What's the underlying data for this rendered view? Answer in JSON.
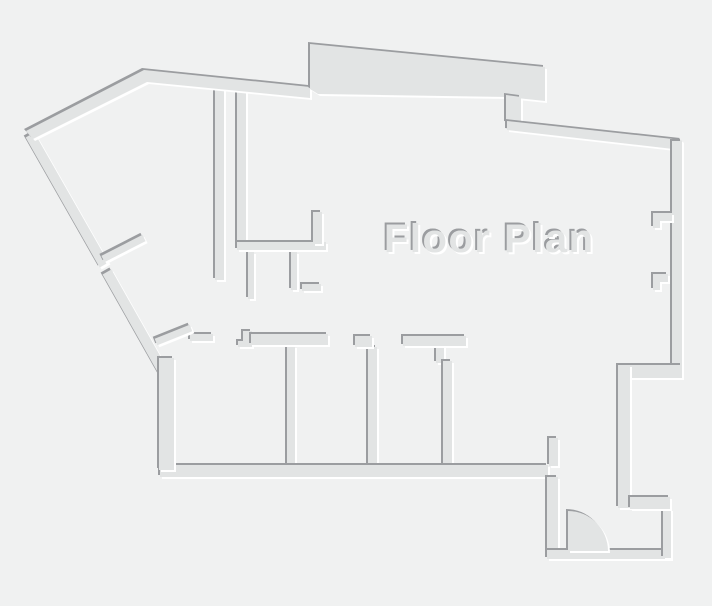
{
  "floorplan": {
    "title": "Floor Plan",
    "canvas": {
      "width": 712,
      "height": 606
    },
    "colors": {
      "background": "#f0f1f1",
      "wall_fill": "#e2e4e4",
      "edge_shadow": "#9b9da0",
      "edge_highlight": "#ffffff"
    },
    "title_pos": {
      "x": 384,
      "y": 252
    },
    "shapes": [
      {
        "name": "corridor-wall-left",
        "rect": [
          215,
          88,
          9,
          192
        ]
      },
      {
        "name": "corridor-wall-right",
        "rect": [
          237,
          90,
          9,
          159
        ]
      },
      {
        "name": "closet-stub-1",
        "rect": [
          248,
          252,
          6,
          47
        ]
      },
      {
        "name": "closet-stub-2",
        "rect": [
          291,
          252,
          6,
          38
        ]
      },
      {
        "name": "closet-stub-3",
        "rect": [
          302,
          284,
          19,
          7
        ]
      },
      {
        "name": "closet-wall-horizontal",
        "rect": [
          237,
          242,
          89,
          8
        ]
      },
      {
        "name": "closet-stub-up",
        "rect": [
          313,
          212,
          9,
          32
        ]
      },
      {
        "name": "diagonal-wall-upper",
        "points": "25.7,137.5 34.3,132.5 108.4,262.5 99.7,267.5"
      },
      {
        "name": "diagonal-wall-lower",
        "points": "102.6,274.5 111.4,269.5 168.4,370.5 159.6,375.5"
      },
      {
        "name": "room-divider-1",
        "rect": [
          287,
          346,
          8,
          121
        ]
      },
      {
        "name": "room-divider-2",
        "rect": [
          368,
          347,
          9,
          119
        ]
      },
      {
        "name": "room-divider-3-stub",
        "rect": [
          436,
          344,
          8,
          19
        ]
      },
      {
        "name": "room-divider-3",
        "rect": [
          443,
          361,
          9,
          105
        ]
      },
      {
        "name": "outer-wall-top-left",
        "points": "26,131 144,70 310,87 310,98 147,82 33,139"
      },
      {
        "name": "top-band-wall",
        "points": "310,44 545,67 545,101 507,97 318,94 310,89"
      },
      {
        "name": "top-band-step",
        "points": "506,95 521,97 521,124 506,123"
      },
      {
        "name": "outer-wall-top-right",
        "points": "507,121 682,140 673,149 507,130"
      },
      {
        "name": "outer-wall-right",
        "rect": [
          672,
          141,
          10,
          231
        ]
      },
      {
        "name": "window-jamb-right-1",
        "points": "653,213 672,213 672,221 660,221 660,228 653,228"
      },
      {
        "name": "window-jamb-right-2",
        "points": "653,274 668,274 668,282 660,282 660,290 653,290"
      },
      {
        "name": "right-wall-jog",
        "rect": [
          618,
          365,
          64,
          13
        ]
      },
      {
        "name": "right-wall-lower",
        "rect": [
          618,
          365,
          12,
          143
        ]
      },
      {
        "name": "rooms-bottom-wall",
        "rect": [
          160,
          465,
          388,
          12
        ]
      },
      {
        "name": "outer-wall-left-lower",
        "rect": [
          159,
          358,
          15,
          112
        ]
      },
      {
        "name": "room-top-wall-1",
        "rect": [
          190,
          334,
          23,
          7
        ]
      },
      {
        "name": "room-door-jamb-step",
        "points": "238,347 238,341 243,341 243,331 252,331 252,347"
      },
      {
        "name": "room-top-wall-2",
        "rect": [
          251,
          334,
          77,
          11
        ]
      },
      {
        "name": "room-top-wall-3",
        "rect": [
          355,
          336,
          17,
          11
        ]
      },
      {
        "name": "room-top-wall-4",
        "rect": [
          403,
          336,
          63,
          10
        ]
      },
      {
        "name": "door-leaf-upper",
        "points": "101.4,255.9 142.4,234.9 145.6,241.1 104.6,262.1"
      },
      {
        "name": "door-leaf-lower",
        "points": "154.7,338.8 189.7,324.8 192.3,331.2 157.3,345.2"
      },
      {
        "name": "entry-stub-up",
        "rect": [
          549,
          438,
          9,
          28
        ]
      },
      {
        "name": "entry-wall-left",
        "rect": [
          547,
          477,
          11,
          81
        ]
      },
      {
        "name": "entry-bottom-wall",
        "rect": [
          547,
          550,
          124,
          9
        ]
      },
      {
        "name": "entry-wall-right",
        "rect": [
          663,
          509,
          8,
          49
        ]
      },
      {
        "name": "entry-wall-top",
        "rect": [
          630,
          497,
          40,
          12
        ]
      },
      {
        "name": "entry-door-swing",
        "path": "M568,551 L568,511 A40,40 0 0 1 608,551 Z"
      }
    ]
  }
}
